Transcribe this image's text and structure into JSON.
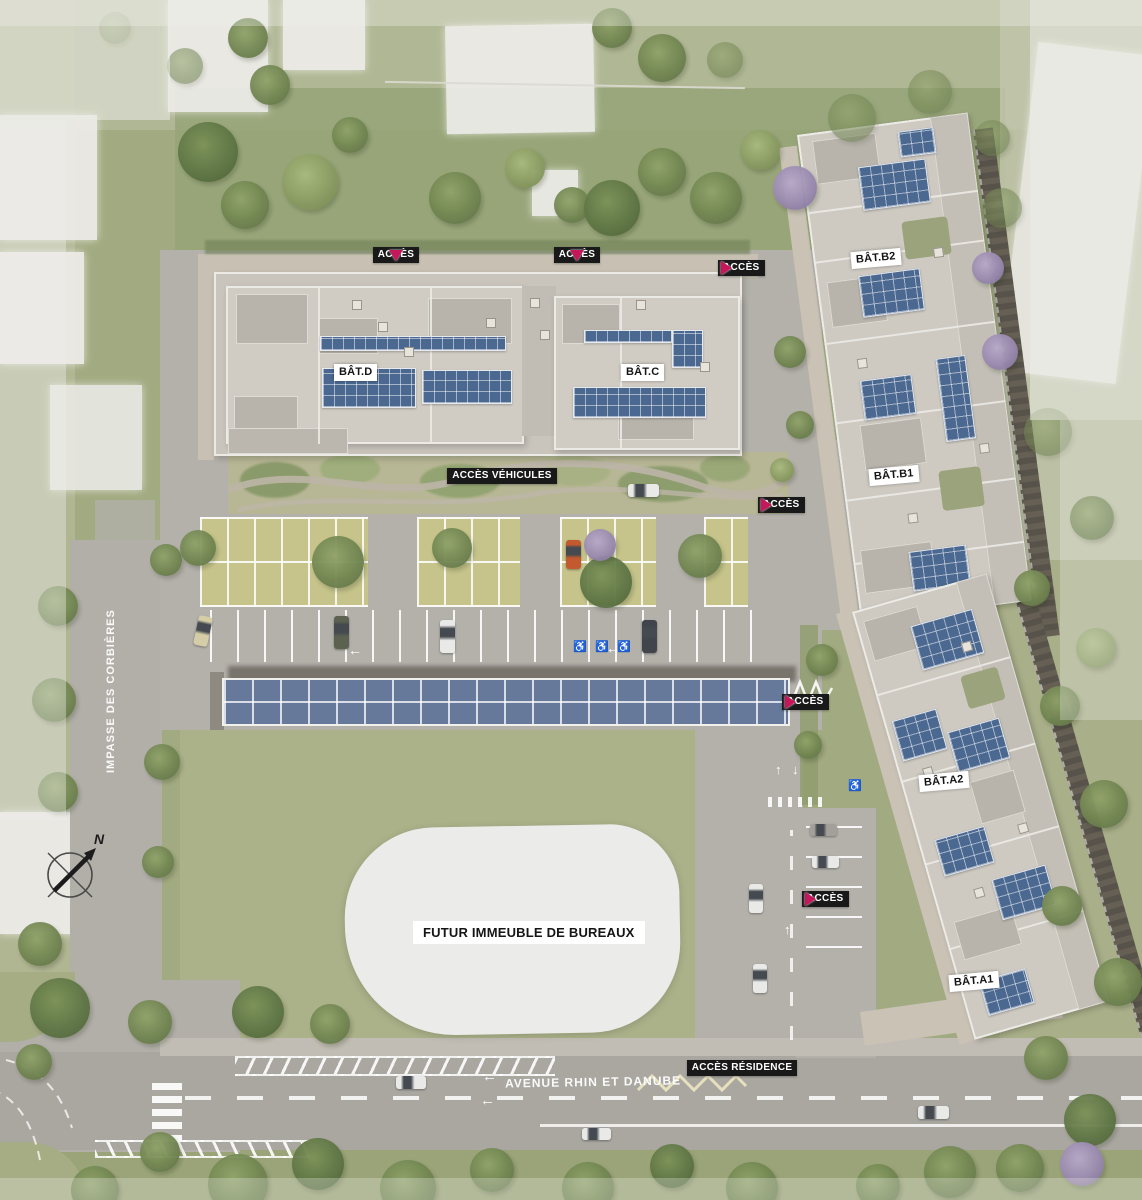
{
  "page": {
    "type": "architectural-site-plan"
  },
  "buildings": {
    "bat_d": "BÂT.D",
    "bat_c": "BÂT.C",
    "bat_b2": "BÂT.B2",
    "bat_b1": "BÂT.B1",
    "bat_a2": "BÂT.A2",
    "bat_a1": "BÂT.A1"
  },
  "future_building": {
    "label": "FUTUR IMMEUBLE DE BUREAUX"
  },
  "access": {
    "acces": "ACCÈS",
    "vehicules": "ACCÈS VÉHICULES",
    "residence": "ACCÈS RÉSIDENCE"
  },
  "streets": {
    "avenue": "AVENUE RHIN ET DANUBE",
    "impasse": "IMPASSE DES CORBIÈRES"
  },
  "compass": {
    "north": "N"
  },
  "colors": {
    "accent_pink": "#c6175b",
    "solar_blue": "#4a6890",
    "grass": "#a2aa81",
    "road_gray": "#b2afa9",
    "label_black": "#191919",
    "roof_gray": "#d0ccc4"
  }
}
